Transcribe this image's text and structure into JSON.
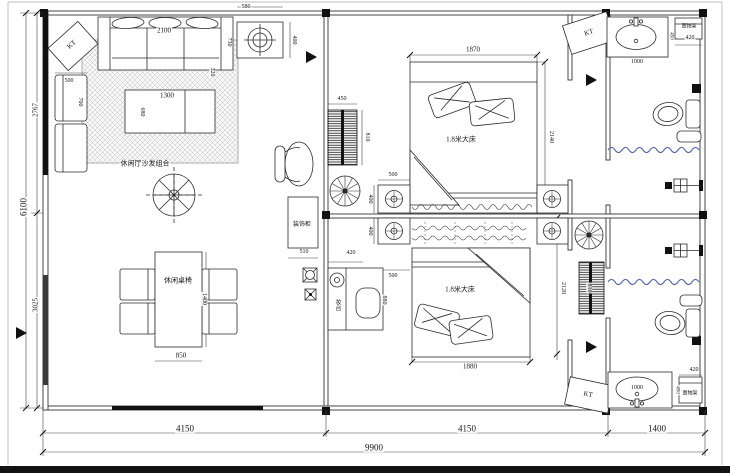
{
  "drawing": {
    "kind": "floor-plan",
    "units": "mm"
  },
  "colors": {
    "line": "#2b2b2b",
    "wall_stroke": "#333333",
    "window_fill": "#111111",
    "curtain_blue": "#4a63b5",
    "hatch": "#bdbdbd",
    "paper": "#ffffff"
  },
  "overall_dimensions": {
    "bottom_segments": [
      "4150",
      "4150",
      "1400"
    ],
    "bottom_total": "9900",
    "left_total": "6100",
    "left_segments": [
      "2767",
      "3025"
    ]
  },
  "labels": [
    {
      "name": "dim-ceiling-light-width",
      "text": "580",
      "x": 246,
      "y": 7,
      "rot": 0,
      "size": 6
    },
    {
      "name": "dim-ceiling-light-depth",
      "text": "400",
      "x": 294,
      "y": 40,
      "rot": 90,
      "size": 6
    },
    {
      "name": "dim-sofa-width",
      "text": "2100",
      "x": 164,
      "y": 31,
      "rot": 0,
      "size": 7
    },
    {
      "name": "dim-sofa-depth",
      "text": "730",
      "x": 229,
      "y": 42,
      "rot": 90,
      "size": 6
    },
    {
      "name": "dim-sofa-gap",
      "text": "320",
      "x": 212,
      "y": 72,
      "rot": 90,
      "size": 6
    },
    {
      "name": "dim-armchair-width",
      "text": "500",
      "x": 69,
      "y": 81,
      "rot": 0,
      "size": 6
    },
    {
      "name": "dim-armchair-depth",
      "text": "700",
      "x": 80,
      "y": 102,
      "rot": 90,
      "size": 6
    },
    {
      "name": "dim-coffee-table-width",
      "text": "1300",
      "x": 167,
      "y": 96,
      "rot": 0,
      "size": 7
    },
    {
      "name": "dim-coffee-table-depth",
      "text": "680",
      "x": 142,
      "y": 112,
      "rot": 90,
      "size": 6
    },
    {
      "name": "label-sofa-area",
      "text": "休闲厅沙发组合",
      "x": 145,
      "y": 164,
      "rot": 0,
      "size": 7
    },
    {
      "name": "label-kt-living",
      "text": "KT",
      "x": 72,
      "y": 45,
      "rot": -42,
      "size": 7
    },
    {
      "name": "label-dining",
      "text": "休闲桌椅",
      "x": 178,
      "y": 281,
      "rot": 0,
      "size": 7
    },
    {
      "name": "dim-dining-table-length",
      "text": "1400",
      "x": 204,
      "y": 299,
      "rot": 90,
      "size": 6
    },
    {
      "name": "dim-dining-table-width",
      "text": "850",
      "x": 181,
      "y": 356,
      "rot": 0,
      "size": 7
    },
    {
      "name": "label-deco-cabinet",
      "text": "装饰柜",
      "x": 302,
      "y": 225,
      "rot": 0,
      "size": 6
    },
    {
      "name": "dim-deco-cabinet",
      "text": "510",
      "x": 304,
      "y": 252,
      "rot": 0,
      "size": 6
    },
    {
      "name": "dim-radiator1-width",
      "text": "450",
      "x": 342,
      "y": 99,
      "rot": 0,
      "size": 6
    },
    {
      "name": "dim-radiator1-height",
      "text": "810",
      "x": 367,
      "y": 137,
      "rot": 90,
      "size": 6
    },
    {
      "name": "dim-bed1-width",
      "text": "1870",
      "x": 473,
      "y": 50,
      "rot": 0,
      "size": 7
    },
    {
      "name": "dim-bed1-length",
      "text": "2140",
      "x": 551,
      "y": 137,
      "rot": 90,
      "size": 6
    },
    {
      "name": "label-bed1",
      "text": "1.8米大床",
      "x": 461,
      "y": 140,
      "rot": 0,
      "size": 7
    },
    {
      "name": "dim-nightstand1-width",
      "text": "500",
      "x": 393,
      "y": 175,
      "rot": 0,
      "size": 6
    },
    {
      "name": "dim-nightstand1-depth",
      "text": "400",
      "x": 370,
      "y": 199,
      "rot": 90,
      "size": 6
    },
    {
      "name": "dim-nightstand2-depth",
      "text": "400",
      "x": 370,
      "y": 231,
      "rot": 90,
      "size": 6
    },
    {
      "name": "dim-nightstand2-width",
      "text": "500",
      "x": 393,
      "y": 276,
      "rot": 0,
      "size": 6
    },
    {
      "name": "dim-dresser-width",
      "text": "420",
      "x": 351,
      "y": 253,
      "rot": 0,
      "size": 6
    },
    {
      "name": "label-dresser",
      "text": "妆台",
      "x": 337,
      "y": 305,
      "rot": 0,
      "size": 6,
      "vert": true
    },
    {
      "name": "dim-dresser-length",
      "text": "880",
      "x": 384,
      "y": 300,
      "rot": 90,
      "size": 6
    },
    {
      "name": "label-bed2",
      "text": "1.8米大床",
      "x": 460,
      "y": 290,
      "rot": 0,
      "size": 7
    },
    {
      "name": "dim-bed2-width",
      "text": "1880",
      "x": 470,
      "y": 367,
      "rot": 0,
      "size": 7
    },
    {
      "name": "dim-bed2-length",
      "text": "2120",
      "x": 563,
      "y": 288,
      "rot": 90,
      "size": 6
    },
    {
      "name": "dim-radiator2-height",
      "text": "810",
      "x": 589,
      "y": 288,
      "rot": 90,
      "size": 6
    },
    {
      "name": "label-kt-top",
      "text": "KT",
      "x": 589,
      "y": 33,
      "rot": -18,
      "size": 7
    },
    {
      "name": "label-kt-bottom",
      "text": "KT",
      "x": 588,
      "y": 395,
      "rot": 12,
      "size": 7
    },
    {
      "name": "dim-vanity-top",
      "text": "1000",
      "x": 637,
      "y": 62,
      "rot": 0,
      "size": 6
    },
    {
      "name": "dim-vanity-top-depth",
      "text": "450",
      "x": 671,
      "y": 36,
      "rot": 90,
      "size": 5
    },
    {
      "name": "label-shelf-top",
      "text": "置物架",
      "x": 689,
      "y": 27,
      "rot": 0,
      "size": 5
    },
    {
      "name": "dim-shelf-top",
      "text": "420",
      "x": 690,
      "y": 38,
      "rot": 0,
      "size": 6
    },
    {
      "name": "dim-vanity-bottom",
      "text": "1000",
      "x": 637,
      "y": 388,
      "rot": 0,
      "size": 6
    },
    {
      "name": "dim-vanity-bottom-depth",
      "text": "450",
      "x": 677,
      "y": 390,
      "rot": 90,
      "size": 5
    },
    {
      "name": "label-shelf-bottom",
      "text": "置物架",
      "x": 690,
      "y": 394,
      "rot": 0,
      "size": 5
    },
    {
      "name": "dim-shelf-bottom",
      "text": "420",
      "x": 694,
      "y": 370,
      "rot": 0,
      "size": 6
    },
    {
      "name": "dim-bottom-left",
      "text": "4150",
      "x": 185,
      "y": 429,
      "rot": 0,
      "size": 9
    },
    {
      "name": "dim-bottom-mid",
      "text": "4150",
      "x": 467,
      "y": 429,
      "rot": 0,
      "size": 9
    },
    {
      "name": "dim-bottom-right",
      "text": "1400",
      "x": 657,
      "y": 429,
      "rot": 0,
      "size": 9
    },
    {
      "name": "dim-bottom-total",
      "text": "9900",
      "x": 374,
      "y": 448,
      "rot": 0,
      "size": 9
    },
    {
      "name": "dim-left-total",
      "text": "6100",
      "x": 24,
      "y": 207,
      "rot": -90,
      "size": 9
    },
    {
      "name": "dim-left-upper",
      "text": "2767",
      "x": 36,
      "y": 110,
      "rot": -90,
      "size": 7
    },
    {
      "name": "dim-left-lower",
      "text": "3025",
      "x": 36,
      "y": 305,
      "rot": -90,
      "size": 7
    }
  ]
}
